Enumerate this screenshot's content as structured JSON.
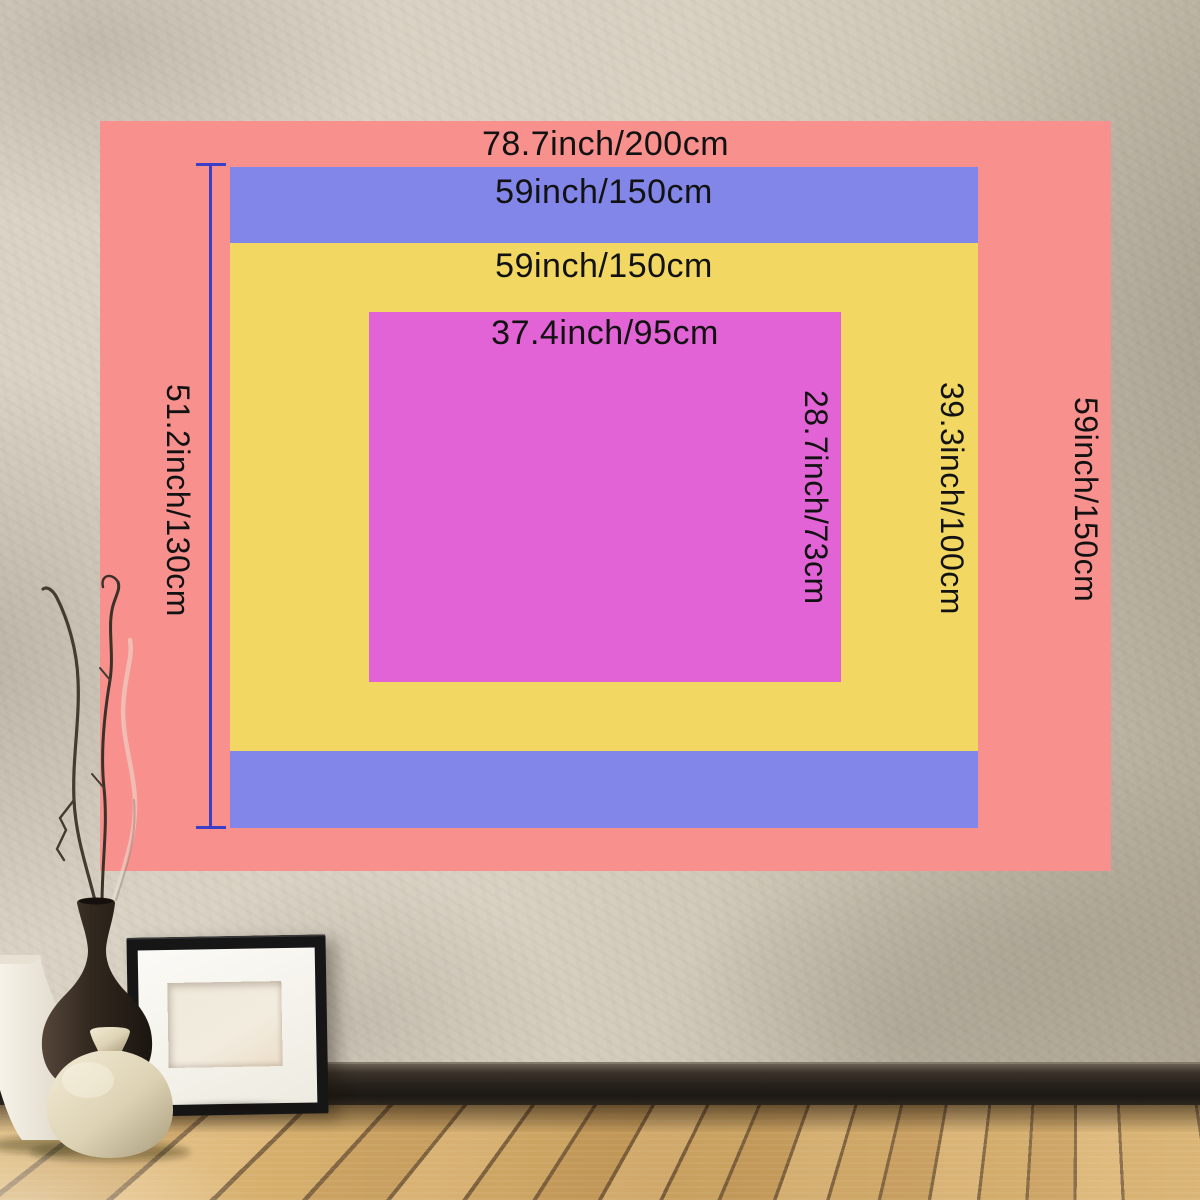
{
  "product": {
    "sizes": [
      {
        "color": "#f8908d",
        "width_label": "78.7inch/200cm",
        "height_label": "59inch/150cm"
      },
      {
        "color": "#8186e8",
        "width_label": "59inch/150cm",
        "height_label": "51.2inch/130cm"
      },
      {
        "color": "#f2d862",
        "width_label": "59inch/150cm",
        "height_label": "39.3inch/100cm"
      },
      {
        "color": "#e263d6",
        "width_label": "37.4inch/95cm",
        "height_label": "28.7inch/73cm"
      }
    ]
  },
  "colors": {
    "dimension_line": "#3c3ec5",
    "label_text": "#121212"
  }
}
